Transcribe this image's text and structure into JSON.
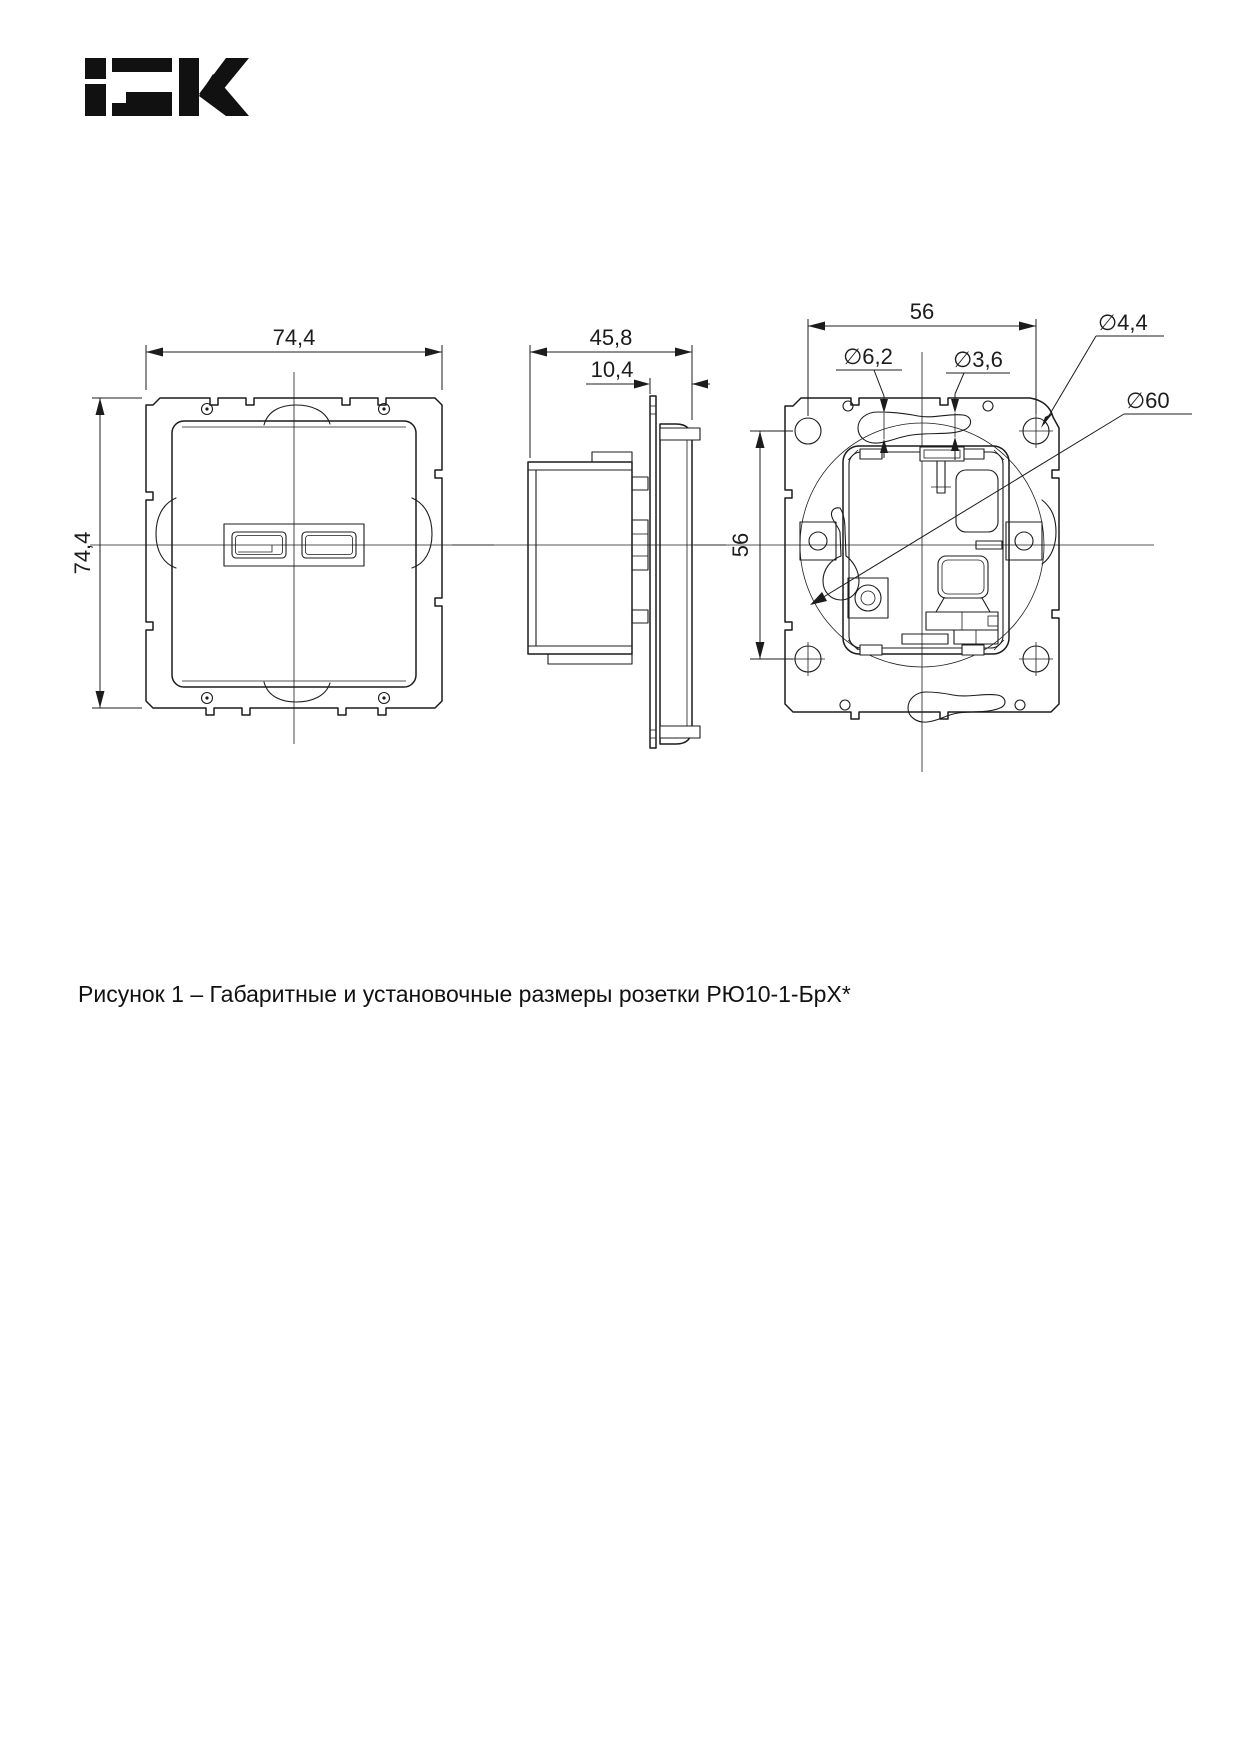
{
  "page": {
    "background": "#ffffff",
    "line_color": "#1c1c1c"
  },
  "logo": {
    "brand": "IEK"
  },
  "figure": {
    "caption": "Рисунок 1 – Габаритные и установочные размеры розетки РЮ10-1-БрХ*",
    "front_view": {
      "width_label": "74,4",
      "height_label": "74,4"
    },
    "side_view": {
      "depth_label": "45,8",
      "front_depth_label": "10,4"
    },
    "rear_view": {
      "hole_spacing_h_label": "56",
      "hole_spacing_v_label": "56",
      "slot_large_dia_label": "∅6,2",
      "slot_small_dia_label": "∅3,6",
      "corner_hole_dia_label": "∅4,4",
      "install_dia_label": "∅60"
    }
  }
}
